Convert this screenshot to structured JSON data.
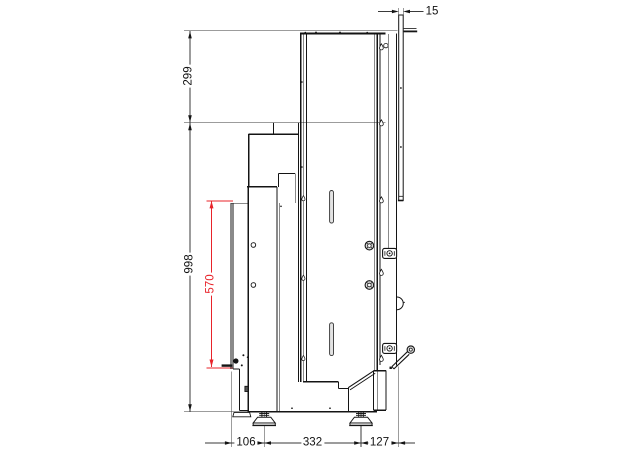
{
  "drawing": {
    "kind": "technical-side-view-dimension-drawing",
    "colors": {
      "line": "#141414",
      "thin_line": "#3a3a3a",
      "highlight_dimension": "#e8232a",
      "slot_fill": "#e3e3e3",
      "background": "#ffffff"
    },
    "dimensions": {
      "rear_panel_thickness": {
        "value": "15",
        "orientation": "horizontal"
      },
      "upper_section_height": {
        "value": "299",
        "orientation": "vertical"
      },
      "main_body_height": {
        "value": "998",
        "orientation": "vertical"
      },
      "front_door_height": {
        "value": "570",
        "orientation": "vertical",
        "color": "#e8232a"
      },
      "base_front_offset": {
        "value": "106",
        "orientation": "horizontal"
      },
      "base_feet_spacing": {
        "value": "332",
        "orientation": "horizontal"
      },
      "base_rear_offset": {
        "value": "127",
        "orientation": "horizontal"
      }
    }
  }
}
